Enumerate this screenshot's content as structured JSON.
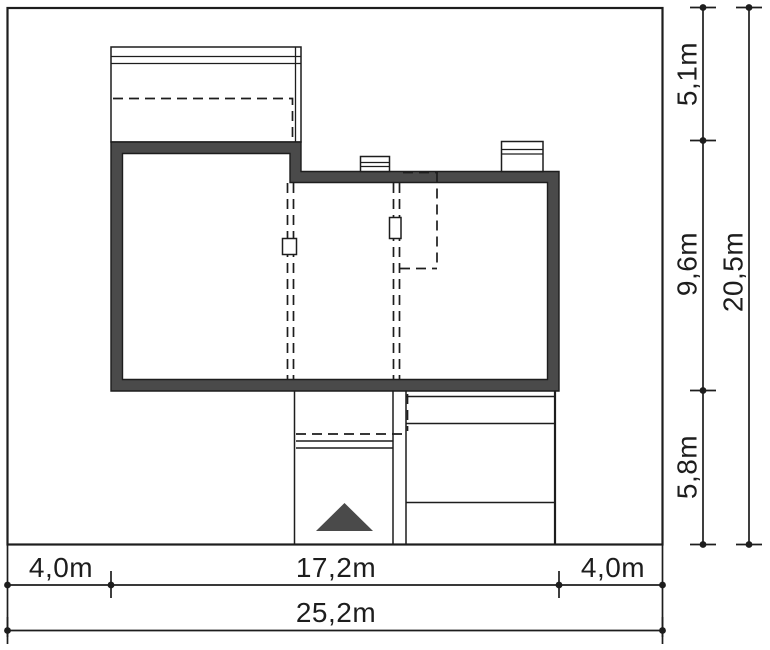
{
  "drawing_type": "site-plan",
  "colors": {
    "wall": "#4a4a4a",
    "line": "#1d1d1d",
    "background": "#ffffff"
  },
  "dimensions": {
    "bottom": {
      "segments": [
        {
          "label": "4,0m",
          "value": 4.0
        },
        {
          "label": "17,2m",
          "value": 17.2
        },
        {
          "label": "4,0m",
          "value": 4.0
        }
      ],
      "total": {
        "label": "25,2m",
        "value": 25.2
      }
    },
    "right": {
      "segments": [
        {
          "label": "5,1m",
          "value": 5.1
        },
        {
          "label": "9,6m",
          "value": 9.6
        },
        {
          "label": "5,8m",
          "value": 5.8
        }
      ],
      "total": {
        "label": "20,5m",
        "value": 20.5
      }
    }
  }
}
